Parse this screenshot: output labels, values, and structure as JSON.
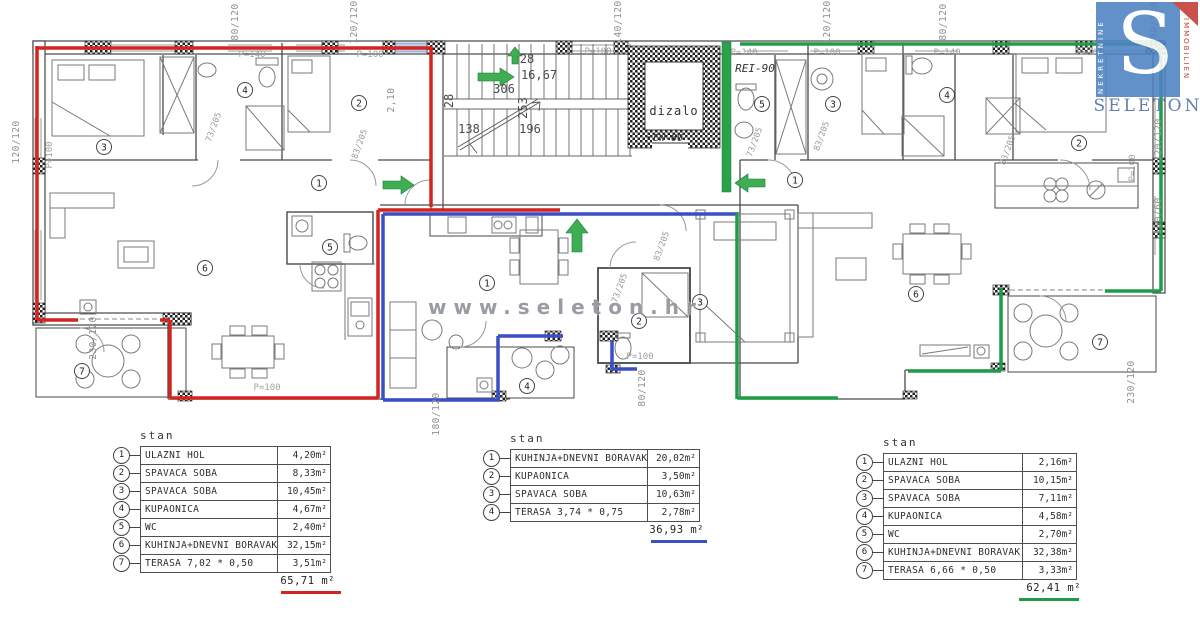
{
  "branding": {
    "watermark": "www.seleton.hr",
    "logo_letter": "S",
    "logo_left_text": "NEKRETNINE",
    "logo_right_text": "IMMOBILIEN",
    "logo_name": "SELETON",
    "logo_bg": "#4d82c3",
    "logo_accent_red": "#c23a34"
  },
  "plan": {
    "labels": {
      "elevator": "dizalo",
      "elevator_code": "EW-60",
      "fire_rating": "REI-90"
    },
    "apartment_colors": {
      "left": "#d42420",
      "middle": "#3a4fc4",
      "right": "#1f9c47"
    },
    "arrow_color": "#3fae52",
    "room_markers": [
      {
        "n": "3",
        "x": 104,
        "y": 147
      },
      {
        "n": "4",
        "x": 245,
        "y": 90
      },
      {
        "n": "2",
        "x": 359,
        "y": 103
      },
      {
        "n": "1",
        "x": 319,
        "y": 183
      },
      {
        "n": "5",
        "x": 330,
        "y": 247
      },
      {
        "n": "6",
        "x": 205,
        "y": 268
      },
      {
        "n": "7",
        "x": 82,
        "y": 371
      },
      {
        "n": "1",
        "x": 487,
        "y": 283
      },
      {
        "n": "2",
        "x": 639,
        "y": 321
      },
      {
        "n": "3",
        "x": 700,
        "y": 302
      },
      {
        "n": "4",
        "x": 527,
        "y": 386
      },
      {
        "n": "5",
        "x": 762,
        "y": 104
      },
      {
        "n": "3",
        "x": 833,
        "y": 104
      },
      {
        "n": "4",
        "x": 947,
        "y": 95
      },
      {
        "n": "1",
        "x": 795,
        "y": 180
      },
      {
        "n": "2",
        "x": 1079,
        "y": 143
      },
      {
        "n": "6",
        "x": 916,
        "y": 294
      },
      {
        "n": "7",
        "x": 1100,
        "y": 342
      }
    ],
    "dimensions": [
      {
        "t": "80/120",
        "x": 238,
        "y": 22,
        "r": -90,
        "k": "w"
      },
      {
        "t": "120/120",
        "x": 357,
        "y": 22,
        "r": -90,
        "k": "w"
      },
      {
        "t": "2,10",
        "x": 394,
        "y": 100,
        "r": -90,
        "k": "w"
      },
      {
        "t": "140/120",
        "x": 621,
        "y": 22,
        "r": -90,
        "k": "w"
      },
      {
        "t": "120/120",
        "x": 830,
        "y": 22,
        "r": -90,
        "k": "w"
      },
      {
        "t": "80/120",
        "x": 946,
        "y": 22,
        "r": -90,
        "k": "w"
      },
      {
        "t": "80/120",
        "x": 1157,
        "y": 20,
        "r": -90,
        "k": "w"
      },
      {
        "t": "120/120",
        "x": 19,
        "y": 142,
        "r": -90,
        "k": "w"
      },
      {
        "t": "230/120",
        "x": 96,
        "y": 338,
        "r": -90,
        "k": "w"
      },
      {
        "t": "180/120",
        "x": 439,
        "y": 414,
        "r": -90,
        "k": "w"
      },
      {
        "t": "80/120",
        "x": 645,
        "y": 388,
        "r": -90,
        "k": "w"
      },
      {
        "t": "230/120",
        "x": 1134,
        "y": 382,
        "r": -90,
        "k": "w"
      },
      {
        "t": "120/120",
        "x": 1161,
        "y": 140,
        "r": -90,
        "k": "w"
      },
      {
        "t": "100/60",
        "x": 1161,
        "y": 216,
        "r": -90,
        "k": "w"
      },
      {
        "t": "P=100",
        "x": 52,
        "y": 155,
        "r": -90,
        "k": "p"
      },
      {
        "t": "P=100",
        "x": 1135,
        "y": 168,
        "r": -90,
        "k": "p"
      },
      {
        "t": "P=140",
        "x": 252,
        "y": 57,
        "r": 0,
        "k": "p"
      },
      {
        "t": "P=100",
        "x": 370,
        "y": 57,
        "r": 0,
        "k": "p"
      },
      {
        "t": "P=100",
        "x": 598,
        "y": 54,
        "r": 0,
        "k": "p"
      },
      {
        "t": "P=140",
        "x": 744,
        "y": 55,
        "r": 0,
        "k": "p"
      },
      {
        "t": "P=100",
        "x": 827,
        "y": 55,
        "r": 0,
        "k": "p"
      },
      {
        "t": "P=140",
        "x": 947,
        "y": 55,
        "r": 0,
        "k": "p"
      },
      {
        "t": "P=100",
        "x": 1090,
        "y": 55,
        "r": 0,
        "k": "p"
      },
      {
        "t": "P=100",
        "x": 267,
        "y": 390,
        "r": 0,
        "k": "p"
      },
      {
        "t": "P=100",
        "x": 640,
        "y": 359,
        "r": 0,
        "k": "p"
      },
      {
        "t": "73/205",
        "x": 216,
        "y": 128,
        "r": -70,
        "k": "d"
      },
      {
        "t": "83/205",
        "x": 362,
        "y": 145,
        "r": -70,
        "k": "d"
      },
      {
        "t": "73/205",
        "x": 757,
        "y": 143,
        "r": -70,
        "k": "d"
      },
      {
        "t": "83/205",
        "x": 824,
        "y": 137,
        "r": -70,
        "k": "d"
      },
      {
        "t": "83/205",
        "x": 1010,
        "y": 151,
        "r": -70,
        "k": "d"
      },
      {
        "t": "73/205",
        "x": 622,
        "y": 289,
        "r": -70,
        "k": "d"
      },
      {
        "t": "83/205",
        "x": 664,
        "y": 247,
        "r": -70,
        "k": "d"
      },
      {
        "t": "28",
        "x": 527,
        "y": 63,
        "r": 0,
        "k": "s"
      },
      {
        "t": "16,67",
        "x": 539,
        "y": 79,
        "r": 0,
        "k": "s"
      },
      {
        "t": "306",
        "x": 504,
        "y": 93,
        "r": 0,
        "k": "s"
      },
      {
        "t": "253",
        "x": 527,
        "y": 108,
        "r": -90,
        "k": "s"
      },
      {
        "t": "28",
        "x": 453,
        "y": 101,
        "r": -90,
        "k": "s"
      },
      {
        "t": "138",
        "x": 469,
        "y": 133,
        "r": 0,
        "k": "s"
      },
      {
        "t": "196",
        "x": 530,
        "y": 133,
        "r": 0,
        "k": "s"
      }
    ]
  },
  "unit_suffix": "m²",
  "tables": [
    {
      "title": "stan",
      "accent": "#d42420",
      "cls": "t1",
      "under": {
        "left": 141,
        "width": 60
      },
      "rows": [
        {
          "n": "1",
          "name": "ULAZNI HOL",
          "area": "4,20"
        },
        {
          "n": "2",
          "name": "SPAVAĆA SOBA",
          "area": "8,33"
        },
        {
          "n": "3",
          "name": "SPAVAĆA SOBA",
          "area": "10,45"
        },
        {
          "n": "4",
          "name": "KUPAONICA",
          "area": "4,67"
        },
        {
          "n": "5",
          "name": "WC",
          "area": "2,40"
        },
        {
          "n": "6",
          "name": "KUHINJA+DNEVNI BORAVAK",
          "area": "32,15"
        },
        {
          "n": "7",
          "name": "TERASA 7,02 * 0,50",
          "area": "3,51"
        }
      ],
      "total": "65,71"
    },
    {
      "title": "stan",
      "accent": "#3a4fc4",
      "cls": "t2",
      "under": {
        "left": 141,
        "width": 56
      },
      "rows": [
        {
          "n": "1",
          "name": "KUHINJA+DNEVNI BORAVAK",
          "area": "20,02"
        },
        {
          "n": "2",
          "name": "KUPAONICA",
          "area": "3,50"
        },
        {
          "n": "3",
          "name": "SPAVAĆA SOBA",
          "area": "10,63"
        },
        {
          "n": "4",
          "name": "TERASA 3,74 * 0,75",
          "area": "2,78"
        }
      ],
      "total": "36,93"
    },
    {
      "title": "stan",
      "accent": "#1f9c47",
      "cls": "t3",
      "under": {
        "left": 136,
        "width": 60
      },
      "rows": [
        {
          "n": "1",
          "name": "ULAZNI HOL",
          "area": "2,16"
        },
        {
          "n": "2",
          "name": "SPAVAĆA SOBA",
          "area": "10,15"
        },
        {
          "n": "3",
          "name": "SPAVAĆA SOBA",
          "area": "7,11"
        },
        {
          "n": "4",
          "name": "KUPAONICA",
          "area": "4,58"
        },
        {
          "n": "5",
          "name": "WC",
          "area": "2,70"
        },
        {
          "n": "6",
          "name": "KUHINJA+DNEVNI BORAVAK",
          "area": "32,38"
        },
        {
          "n": "7",
          "name": "TERASA 6,66 * 0,50",
          "area": "3,33"
        }
      ],
      "total": "62,41"
    }
  ]
}
